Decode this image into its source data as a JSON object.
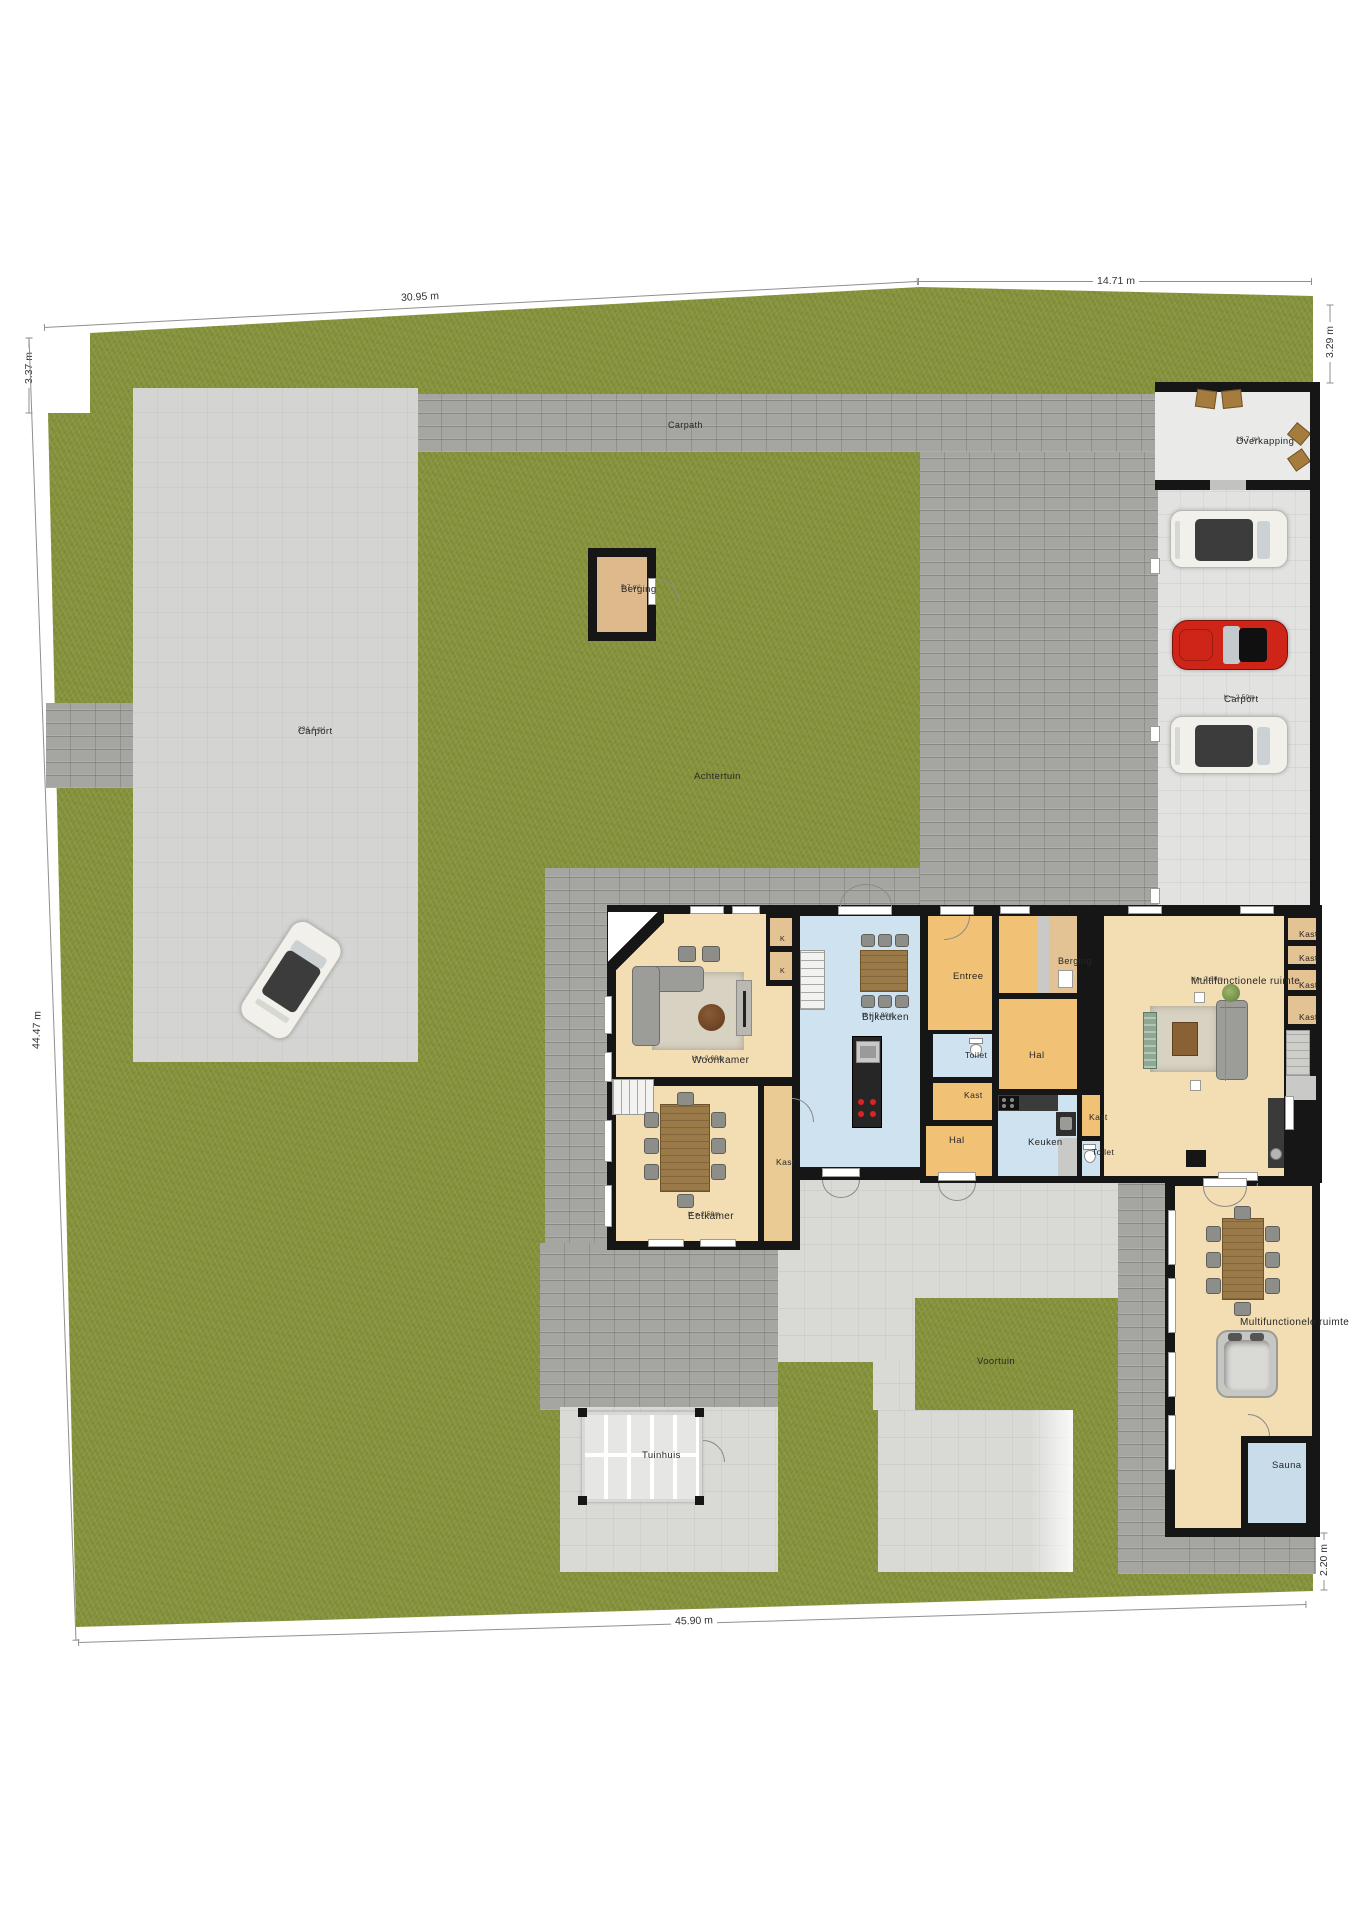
{
  "plan_title": "Situatie / begane grond plattegrond",
  "palette": {
    "grass": "#87923e",
    "paving_brick": "#a5a5a1",
    "paving_concrete": "#d9d9d6",
    "wall": "#161616",
    "room_beige": "#f3ddb3",
    "room_orange": "#f1c276",
    "room_blue": "#cfe2ef",
    "car_red": "#cf2418"
  },
  "labels": [
    {
      "id": "carpath",
      "text": "Carpath",
      "x": 668,
      "y": 420,
      "fs": 9
    },
    {
      "id": "overkapping",
      "text": "Overkapping",
      "sub": "18.7 m²",
      "x": 1236,
      "y": 436,
      "fs": 9.5
    },
    {
      "id": "berging-garden",
      "text": "Berging",
      "sub": "5.7 m²",
      "x": 621,
      "y": 584,
      "fs": 9.5
    },
    {
      "id": "carport-area",
      "text": "Carport",
      "sub": "234.4 m²",
      "x": 298,
      "y": 726,
      "fs": 9.5
    },
    {
      "id": "achtertuin",
      "text": "Achtertuin",
      "x": 694,
      "y": 771,
      "fs": 9.5
    },
    {
      "id": "carport-structure",
      "text": "Carport",
      "sub": "h = 2.50m",
      "x": 1224,
      "y": 694,
      "fs": 9.5
    },
    {
      "id": "woonkamer",
      "text": "Woonkamer",
      "sub": "H = 2.60m",
      "x": 692,
      "y": 1055,
      "fs": 10
    },
    {
      "id": "closet-k1",
      "text": "K",
      "x": 780,
      "y": 936,
      "fs": 7
    },
    {
      "id": "closet-k2",
      "text": "K",
      "x": 780,
      "y": 968,
      "fs": 7
    },
    {
      "id": "bijkeuken",
      "text": "Bijkeuken",
      "sub": "H = 2.90m",
      "x": 862,
      "y": 1012,
      "fs": 10
    },
    {
      "id": "entree",
      "text": "Entree",
      "x": 953,
      "y": 971,
      "fs": 9.5
    },
    {
      "id": "berging-house",
      "text": "Berging",
      "x": 1058,
      "y": 956,
      "fs": 9
    },
    {
      "id": "multifunctionele-1",
      "text": "Multifunctionele ruimte",
      "sub": "H = 2.30m",
      "x": 1191,
      "y": 976,
      "fs": 10
    },
    {
      "id": "kast-col-1",
      "text": "Kast",
      "x": 1299,
      "y": 929,
      "fs": 8.5
    },
    {
      "id": "kast-col-2",
      "text": "Kast",
      "x": 1299,
      "y": 953,
      "fs": 8.5
    },
    {
      "id": "kast-col-3",
      "text": "Kast",
      "x": 1299,
      "y": 980,
      "fs": 8.5
    },
    {
      "id": "kast-col-4",
      "text": "Kast",
      "x": 1299,
      "y": 1012,
      "fs": 8.5
    },
    {
      "id": "toilet-1",
      "text": "Toilet",
      "x": 965,
      "y": 1050,
      "fs": 8.5
    },
    {
      "id": "hal-1",
      "text": "Hal",
      "x": 1029,
      "y": 1050,
      "fs": 9.5
    },
    {
      "id": "kast-a",
      "text": "Kast",
      "x": 964,
      "y": 1090,
      "fs": 8.5
    },
    {
      "id": "hal-2",
      "text": "Hal",
      "x": 949,
      "y": 1135,
      "fs": 9.5
    },
    {
      "id": "keuken",
      "text": "Keuken",
      "x": 1028,
      "y": 1137,
      "fs": 9.5
    },
    {
      "id": "kast-b",
      "text": "Kast",
      "x": 1089,
      "y": 1112,
      "fs": 8.5
    },
    {
      "id": "toilet-2",
      "text": "Toilet",
      "x": 1092,
      "y": 1147,
      "fs": 8.5
    },
    {
      "id": "kast-eetkamer",
      "text": "Kast",
      "x": 776,
      "y": 1157,
      "fs": 8.5
    },
    {
      "id": "eetkamer",
      "text": "Eetkamer",
      "sub": "H = 2.59m",
      "x": 688,
      "y": 1211,
      "fs": 10
    },
    {
      "id": "multifunctionele-2",
      "text": "Multifunctionele ruimte",
      "x": 1240,
      "y": 1317,
      "fs": 10
    },
    {
      "id": "sauna",
      "text": "Sauna",
      "x": 1272,
      "y": 1460,
      "fs": 9.5
    },
    {
      "id": "voortuin",
      "text": "Voortuin",
      "x": 977,
      "y": 1356,
      "fs": 9.5
    },
    {
      "id": "tuinhuis",
      "text": "Tuinhuis",
      "x": 642,
      "y": 1450,
      "fs": 9.5
    }
  ],
  "dimensions": [
    {
      "id": "dim-top-left",
      "text": "30.95 m",
      "x1": 44,
      "y1": 327,
      "x2": 918,
      "y2": 281,
      "lx": 420,
      "ly": 297,
      "rot": -3
    },
    {
      "id": "dim-top-right",
      "text": "14.71 m",
      "x1": 918,
      "y1": 281,
      "x2": 1312,
      "y2": 281,
      "lx": 1116,
      "ly": 281,
      "rot": 0
    },
    {
      "id": "dim-left-notch",
      "text": "3.37 m",
      "x1": 29,
      "y1": 337,
      "x2": 29,
      "y2": 413,
      "lx": 29,
      "ly": 368,
      "rot": -90
    },
    {
      "id": "dim-left",
      "text": "44.47 m",
      "x1": 29,
      "y1": 337,
      "x2": 76,
      "y2": 1640,
      "lx": 37,
      "ly": 1030,
      "rot": -88
    },
    {
      "id": "dim-right-top",
      "text": "3.29 m",
      "x1": 1330,
      "y1": 304,
      "x2": 1330,
      "y2": 383,
      "lx": 1330,
      "ly": 342,
      "rot": -90
    },
    {
      "id": "dim-right-bottom",
      "text": "2.20 m",
      "x1": 1324,
      "y1": 1532,
      "x2": 1324,
      "y2": 1590,
      "lx": 1324,
      "ly": 1560,
      "rot": -90
    },
    {
      "id": "dim-bottom",
      "text": "45.90 m",
      "x1": 78,
      "y1": 1642,
      "x2": 1306,
      "y2": 1604,
      "lx": 694,
      "ly": 1621,
      "rot": -1.8
    }
  ]
}
